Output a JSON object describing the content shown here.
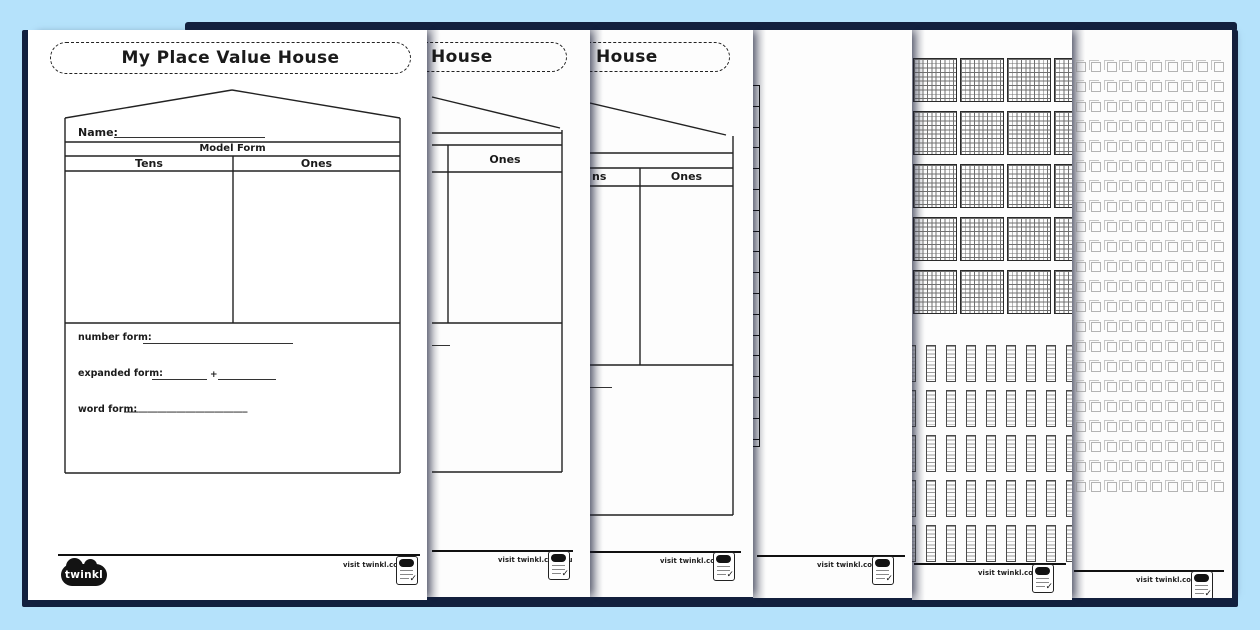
{
  "colors": {
    "background": "#b5e2fb",
    "page_shadow": "#13213f",
    "page": "#ffffff",
    "ink": "#1a1a1a"
  },
  "worksheet": {
    "title_full": "My Place Value House",
    "title_partial": "House",
    "name_label": "Name:",
    "model_form_label": "Model Form",
    "tens_label": "Tens",
    "tens_partial": "ns",
    "ones_label": "Ones",
    "number_form_label": "number form:",
    "expanded_form_label": "expanded form:",
    "plus_sign": "+",
    "word_form_label": "word form:",
    "word_form_line": "__________________________"
  },
  "footer": {
    "visit_text": "visit twinkl.com.au",
    "brand": "twinkl",
    "badge_check": "✓"
  },
  "manipulatives": {
    "hundreds_grid": {
      "rows": 5,
      "cols": 4,
      "cell_rows": 10,
      "cell_cols": 10
    },
    "tens_rods": {
      "rows": 5,
      "cols": 10,
      "cells_per_rod": 10
    },
    "ones_units": {
      "rows": 22,
      "cols": 10
    },
    "edge_strip_cells": 17
  }
}
